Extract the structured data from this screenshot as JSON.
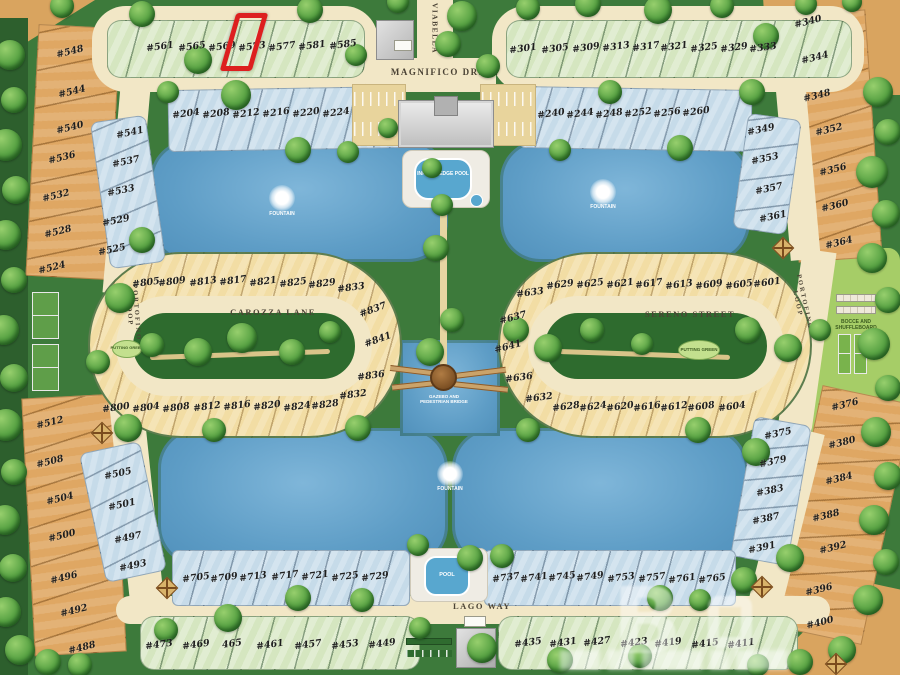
{
  "community": {
    "highlighted_lot": "#573",
    "colors": {
      "lot_green": "#d5e6c0",
      "lot_blue": "#c6dbe9",
      "lot_tan": "#f2dda4",
      "lot_orange": "#dfa763",
      "water": "#5e9dc6",
      "road": "#f2e7c6",
      "grass": "#3d7a3b",
      "highlight": "#dd1f1f"
    }
  },
  "streets": {
    "magnifico": "MAGNIFICO DRIVE",
    "viabella": "VIABELLA",
    "carozza": "CAROZZA LANE",
    "sereno": "SERENO STREET",
    "lago": "LAGO WAY",
    "portofino_left": "PORTOFINO LOOP",
    "portofino_right": "PORTOFINO LOOP"
  },
  "labels": {
    "fountain": "FOUNTAIN",
    "infinity_pool": "INFINITY EDGE POOL",
    "pool": "POOL",
    "putting_green": "PUTTING GREEN",
    "bocce_line1": "BOCCE AND",
    "bocce_line2": "SHUFFLEBOARD",
    "gazebo_line1": "GAZEBO AND",
    "gazebo_line2": "PEDESTRIAN BRIDGE"
  },
  "watermark": {
    "letter": "B"
  },
  "lot_groups": [
    {
      "id": "top-left-green",
      "lots": [
        "#561",
        "#565",
        "#569",
        "#573",
        "#577",
        "#581",
        "#585"
      ]
    },
    {
      "id": "top-right-green",
      "lots": [
        "#301",
        "#305",
        "#309",
        "#313",
        "#317",
        "#321",
        "#325",
        "#329",
        "#333"
      ]
    },
    {
      "id": "row2-left-blue",
      "lots": [
        "#204",
        "#208",
        "#212",
        "#216",
        "#220",
        "#224"
      ]
    },
    {
      "id": "row2-right-blue",
      "lots": [
        "#240",
        "#244",
        "#248",
        "#252",
        "#256",
        "#260"
      ]
    },
    {
      "id": "left-outer-upper",
      "lots": [
        "#548",
        "#544",
        "#540",
        "#536",
        "#532",
        "#528",
        "#524"
      ]
    },
    {
      "id": "left-inner-upper",
      "lots": [
        "#541",
        "#537",
        "#533",
        "#529",
        "#525"
      ]
    },
    {
      "id": "left-outer-lower",
      "lots": [
        "#512",
        "#508",
        "#504",
        "#500",
        "#496",
        "#492",
        "#488"
      ]
    },
    {
      "id": "left-inner-lower",
      "lots": [
        "#505",
        "#501",
        "#497",
        "#493"
      ]
    },
    {
      "id": "island-left-top",
      "lots": [
        "#805",
        "#809",
        "#813",
        "#817",
        "#821",
        "#825",
        "#829",
        "#833"
      ]
    },
    {
      "id": "island-left-curve",
      "lots": [
        "#837",
        "#841"
      ]
    },
    {
      "id": "island-left-bottom",
      "lots": [
        "#800",
        "#804",
        "#808",
        "#812",
        "#816",
        "#820",
        "#824",
        "#828",
        "#832",
        "#836"
      ]
    },
    {
      "id": "island-right-top",
      "lots": [
        "#633",
        "#629",
        "#625",
        "#621",
        "#617",
        "#613",
        "#609",
        "#605",
        "#601"
      ]
    },
    {
      "id": "island-right-curve",
      "lots": [
        "#637",
        "#641"
      ]
    },
    {
      "id": "island-right-bottom",
      "lots": [
        "#636",
        "#632",
        "#628",
        "#624",
        "#620",
        "#616",
        "#612",
        "#608",
        "#604"
      ]
    },
    {
      "id": "bottom-left-blue",
      "lots": [
        "#705",
        "#709",
        "#713",
        "#717",
        "#721",
        "#725",
        "#729"
      ]
    },
    {
      "id": "bottom-right-blue",
      "lots": [
        "#737",
        "#741",
        "#745",
        "#749",
        "#753",
        "#757",
        "#761",
        "#765"
      ]
    },
    {
      "id": "bottom-left-green",
      "lots": [
        "#473",
        "#469",
        "465",
        "#461",
        "#457",
        "#453",
        "#449"
      ]
    },
    {
      "id": "bottom-right-green",
      "lots": [
        "#435",
        "#431",
        "#427",
        "#423",
        "#419",
        "#415",
        "#411"
      ]
    },
    {
      "id": "right-outer-upper",
      "lots": [
        "#340",
        "#344",
        "#348",
        "#352",
        "#356",
        "#360",
        "#364"
      ]
    },
    {
      "id": "right-inner-upper",
      "lots": [
        "#349",
        "#353",
        "#357",
        "#361"
      ]
    },
    {
      "id": "right-outer-lower",
      "lots": [
        "#376",
        "#380",
        "#384",
        "#388",
        "#392",
        "#396",
        "#400"
      ]
    },
    {
      "id": "right-inner-lower",
      "lots": [
        "#375",
        "#379",
        "#383",
        "#387",
        "#391"
      ]
    }
  ]
}
